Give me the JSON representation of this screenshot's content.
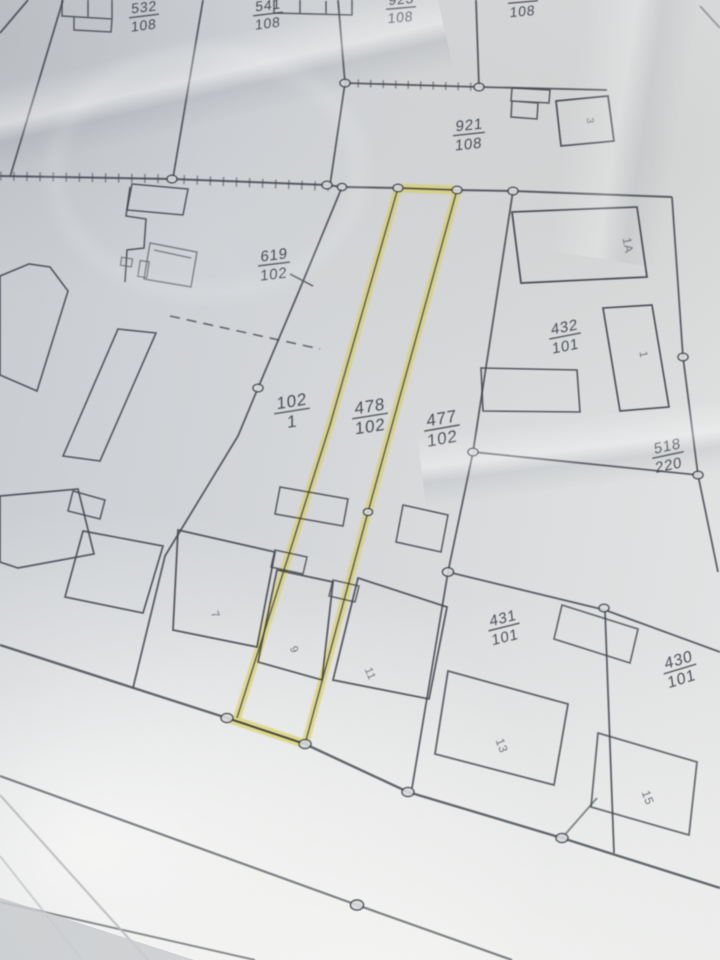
{
  "map": {
    "type": "cadastral-parcel-map-photo",
    "ink_color": "#3f434a",
    "paper_color": "#d4d6d9",
    "highlight": {
      "color": "#d9cf5c",
      "parcel_label": "478/102"
    },
    "labels": {
      "p532": {
        "num": "532",
        "den": "108"
      },
      "p541": {
        "num": "541",
        "den": "108"
      },
      "p923": {
        "num": "923",
        "den": "108"
      },
      "p9xx": {
        "num": "",
        "den": "108"
      },
      "p921": {
        "num": "921",
        "den": "108"
      },
      "p619": {
        "num": "619",
        "den": "102"
      },
      "p102_1": {
        "num": "102",
        "den": "1"
      },
      "p478": {
        "num": "478",
        "den": "102"
      },
      "p477": {
        "num": "477",
        "den": "102"
      },
      "p432": {
        "num": "432",
        "den": "101"
      },
      "p518": {
        "num": "518",
        "den": "220"
      },
      "p431": {
        "num": "431",
        "den": "101"
      },
      "p430": {
        "num": "430",
        "den": "101"
      }
    },
    "building_numbers": {
      "b3": "3",
      "b1a": "1A",
      "b1": "1",
      "b7": "7",
      "b9": "9",
      "b11": "11",
      "b13": "13",
      "b15": "15"
    }
  }
}
